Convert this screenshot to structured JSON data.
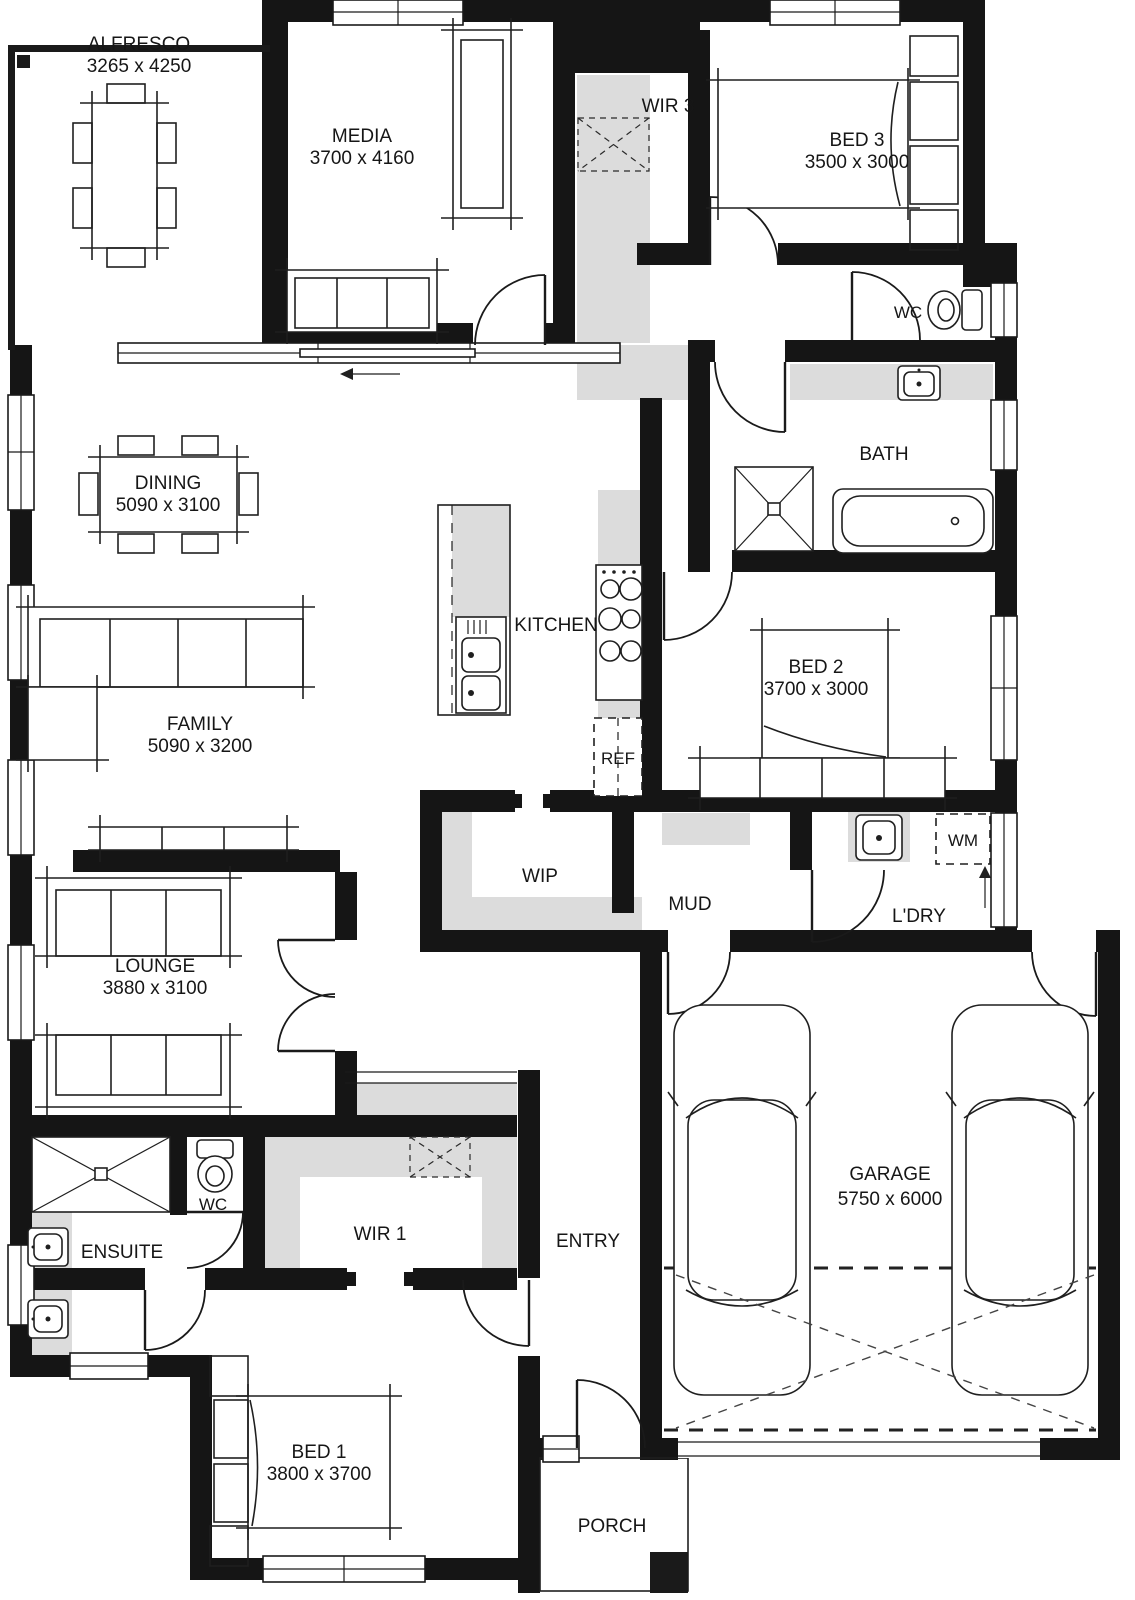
{
  "plan": {
    "title": "house-floor-plan",
    "colors": {
      "wall": "#151515",
      "shelf_gray": "#dcdcdc",
      "line": "#1f1f1f",
      "background": "#ffffff"
    },
    "rooms": [
      {
        "id": "alfresco",
        "label": "ALFRESCO",
        "dims": "3265 x 4250"
      },
      {
        "id": "media",
        "label": "MEDIA",
        "dims": "3700 x 4160"
      },
      {
        "id": "wir3",
        "label": "WIR 3",
        "dims": ""
      },
      {
        "id": "bed3",
        "label": "BED 3",
        "dims": "3500 x 3000"
      },
      {
        "id": "wc-upper",
        "label": "WC",
        "dims": ""
      },
      {
        "id": "bath",
        "label": "BATH",
        "dims": ""
      },
      {
        "id": "dining",
        "label": "DINING",
        "dims": "5090 x 3100"
      },
      {
        "id": "kitchen",
        "label": "KITCHEN",
        "dims": ""
      },
      {
        "id": "ref",
        "label": "REF",
        "dims": ""
      },
      {
        "id": "bed2",
        "label": "BED 2",
        "dims": "3700 x 3000"
      },
      {
        "id": "family",
        "label": "FAMILY",
        "dims": "5090 x 3200"
      },
      {
        "id": "wip",
        "label": "WIP",
        "dims": ""
      },
      {
        "id": "mud",
        "label": "MUD",
        "dims": ""
      },
      {
        "id": "ldry",
        "label": "L'DRY",
        "dims": ""
      },
      {
        "id": "wm",
        "label": "WM",
        "dims": ""
      },
      {
        "id": "lounge",
        "label": "LOUNGE",
        "dims": "3880 x 3100"
      },
      {
        "id": "wc-lower",
        "label": "WC",
        "dims": ""
      },
      {
        "id": "wir1",
        "label": "WIR 1",
        "dims": ""
      },
      {
        "id": "ensuite",
        "label": "ENSUITE",
        "dims": ""
      },
      {
        "id": "entry",
        "label": "ENTRY",
        "dims": ""
      },
      {
        "id": "garage",
        "label": "GARAGE",
        "dims": "5750 x 6000"
      },
      {
        "id": "bed1",
        "label": "BED 1",
        "dims": "3800 x 3700"
      },
      {
        "id": "porch",
        "label": "PORCH",
        "dims": ""
      }
    ]
  }
}
